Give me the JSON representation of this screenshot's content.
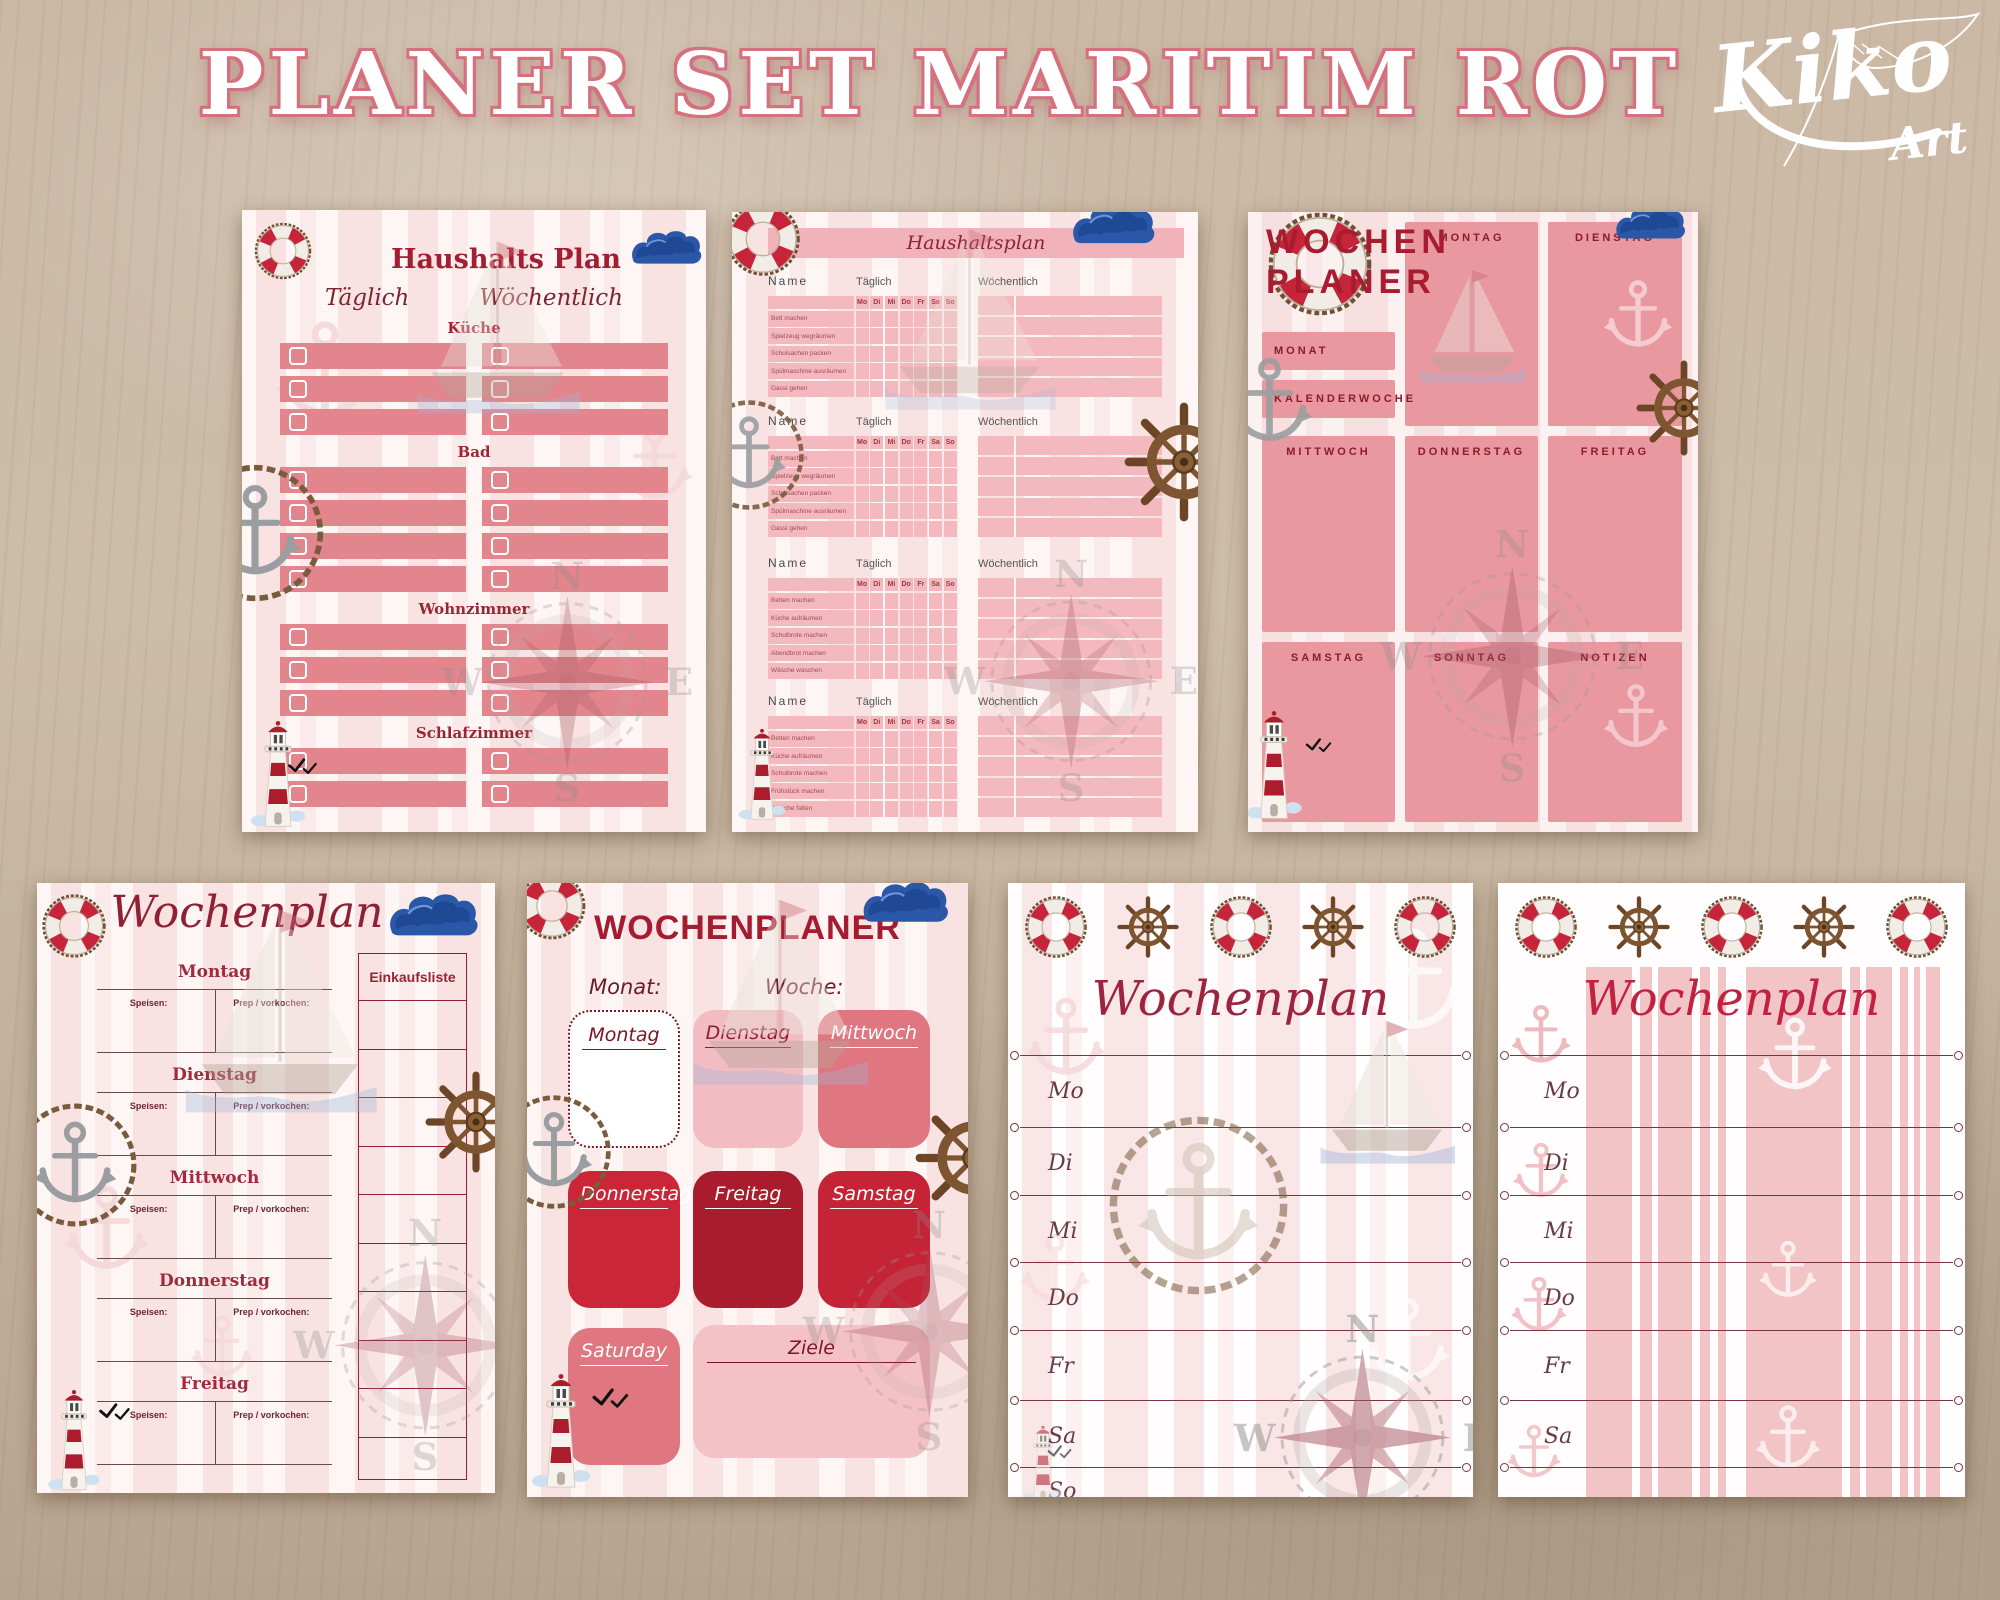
{
  "header": {
    "title": "PLANER SET MARITIM ROT",
    "logo_main": "Kiko",
    "logo_sub": "Art"
  },
  "colors": {
    "accent_dark_red": "#9c1d31",
    "salmon_bar": "#e2858c",
    "table_pink": "#f3b9be",
    "stripe_pink": "#f2c4c6"
  },
  "decor": {
    "compass_n": "N",
    "compass_w": "W",
    "compass_e": "E",
    "compass_s": "S"
  },
  "haushalts_plan": {
    "title": "Haushalts Plan",
    "daily_label": "Täglich",
    "weekly_label": "Wöchentlich",
    "sections": [
      {
        "label": "Küche",
        "rows": 3
      },
      {
        "label": "Bad",
        "rows": 4
      },
      {
        "label": "Wohnzimmer",
        "rows": 3
      },
      {
        "label": "Schlafzimmer",
        "rows": 2
      }
    ]
  },
  "haushaltsplan_tabelle": {
    "title": "Haushaltsplan",
    "name_label": "Name",
    "daily_label": "Täglich",
    "weekly_label": "Wöchentlich",
    "day_headers": [
      "Mo",
      "Di",
      "Mi",
      "Do",
      "Fr",
      "Sa",
      "So"
    ],
    "weekly_rows": 5,
    "sections": [
      {
        "tasks": [
          "Bett machen",
          "Spielzeug wegräumen",
          "Schulsachen packen",
          "Spülmaschine ausräumen",
          "Gassi gehen"
        ]
      },
      {
        "tasks": [
          "Bett machen",
          "Spielzeug wegräumen",
          "Schulsachen packen",
          "Spülmaschine ausräumen",
          "Gassi gehen"
        ]
      },
      {
        "tasks": [
          "Betten machen",
          "Küche aufräumen",
          "Schulbrote machen",
          "Abendbrot machen",
          "Wäsche waschen"
        ]
      },
      {
        "tasks": [
          "Betten machen",
          "Küche aufräumen",
          "Schulbrote machen",
          "Frühstück machen",
          "Wäsche falten"
        ]
      }
    ]
  },
  "wochen_planer": {
    "title_line1": "WOCHEN",
    "title_line2": "PLANER",
    "boxes": [
      {
        "id": "montag",
        "label": "MONTAG"
      },
      {
        "id": "dienstag",
        "label": "DIENSTAG"
      },
      {
        "id": "monat",
        "label": "MONAT"
      },
      {
        "id": "kalenderwoche",
        "label": "KALENDERWOCHE"
      },
      {
        "id": "mittwoch",
        "label": "MITTWOCH"
      },
      {
        "id": "donnerstag",
        "label": "DONNERSTAG"
      },
      {
        "id": "freitag",
        "label": "FREITAG"
      },
      {
        "id": "samstag",
        "label": "SAMSTAG"
      },
      {
        "id": "sonntag",
        "label": "SONNTAG"
      },
      {
        "id": "notizen",
        "label": "NOTIZEN"
      }
    ]
  },
  "wochenplan_speisen": {
    "title": "Wochenplan",
    "days": [
      "Montag",
      "Dienstag",
      "Mittwoch",
      "Donnerstag",
      "Freitag"
    ],
    "meal_label": "Speisen:",
    "prep_label": "Prep / vorkochen:",
    "shopping_title": "Einkaufsliste",
    "shopping_lines": 10
  },
  "wochenplaner_boxen": {
    "title": "WOCHENPLANER",
    "monat_label": "Monat:",
    "woche_label": "Woche:",
    "boxes": [
      {
        "id": "montag",
        "label": "Montag",
        "style": "outline"
      },
      {
        "id": "dienstag",
        "label": "Dienstag",
        "style": "lightpink"
      },
      {
        "id": "mittwoch",
        "label": "Mittwoch",
        "style": "salmon"
      },
      {
        "id": "donnerstag",
        "label": "Donnerstag",
        "style": "red"
      },
      {
        "id": "freitag",
        "label": "Freitag",
        "style": "darkred"
      },
      {
        "id": "samstag",
        "label": "Samstag",
        "style": "red2"
      },
      {
        "id": "saturday",
        "label": "Saturday",
        "style": "salmon"
      },
      {
        "id": "ziele",
        "label": "Ziele",
        "style": "pale"
      }
    ]
  },
  "wochenplan_linien": {
    "title": "Wochenplan",
    "days": [
      "Mo",
      "Di",
      "Mi",
      "Do",
      "Fr",
      "Sa",
      "So"
    ]
  },
  "wochenplan_streifen": {
    "title": "Wochenplan",
    "days": [
      "Mo",
      "Di",
      "Mi",
      "Do",
      "Fr",
      "Sa"
    ]
  }
}
